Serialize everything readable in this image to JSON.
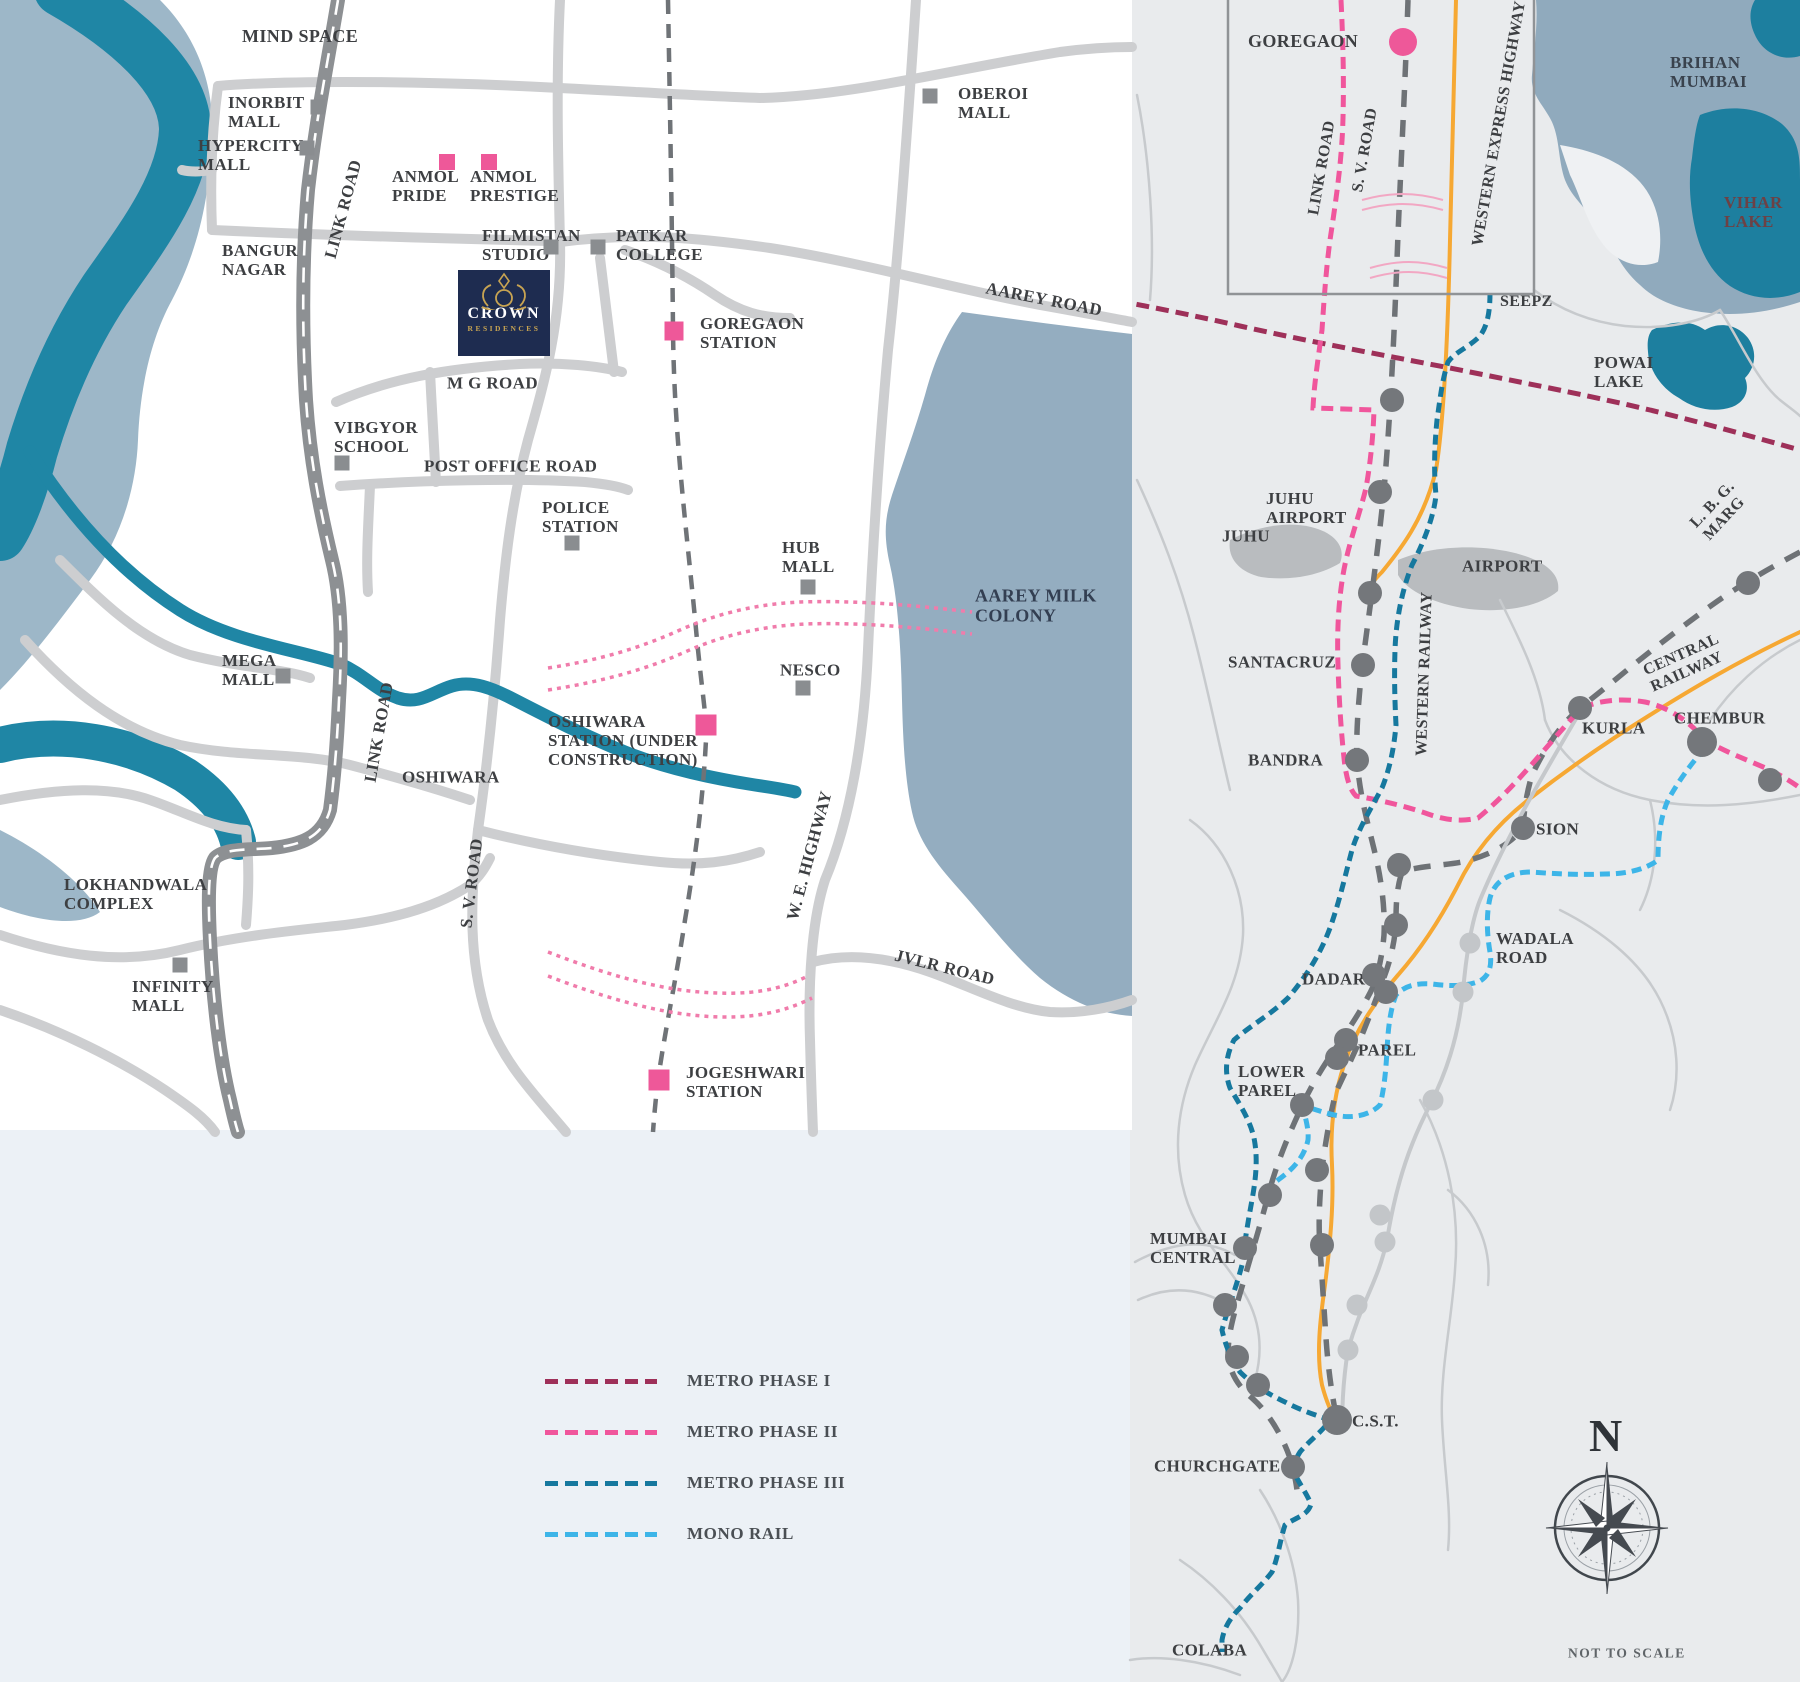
{
  "page": {
    "width": 1800,
    "height": 1682,
    "note": "NOT TO SCALE"
  },
  "colors": {
    "metro_phase_1": "#9e3059",
    "metro_phase_2": "#f0569c",
    "metro_phase_3": "#16789e",
    "mono_rail": "#3db5e8",
    "highway_orange": "#f6a833",
    "water_teal": "#1f86a5",
    "water_steel": "#9db7c8",
    "lake_dark": "#1d7f9f",
    "road_light": "#cdced0",
    "road_dark": "#8d9093",
    "station_pink": "#ee5899",
    "marker_gray": "#8a8d90",
    "label": "#3d3f42",
    "brand_navy": "#1e2c50",
    "brand_gold": "#c8a452"
  },
  "brand": {
    "name": "CROWN",
    "sub": "RESIDENCES"
  },
  "compass": {
    "north_label": "N",
    "note": "NOT TO SCALE"
  },
  "legend": {
    "items": [
      {
        "id": "metro-phase-1",
        "label": "METRO PHASE I",
        "color": "#9e3059",
        "y": 1371
      },
      {
        "id": "metro-phase-2",
        "label": "METRO PHASE II",
        "color": "#f0569c",
        "y": 1422
      },
      {
        "id": "metro-phase-3",
        "label": "METRO PHASE III",
        "color": "#16789e",
        "y": 1473
      },
      {
        "id": "mono-rail",
        "label": "MONO RAIL",
        "color": "#3db5e8",
        "y": 1524
      }
    ],
    "x": 545
  },
  "left_map": {
    "labels": [
      {
        "id": "mind-space",
        "text": "MIND SPACE",
        "x": 242,
        "y": 36,
        "size": 18
      },
      {
        "id": "inorbit-mall",
        "text": "INORBIT\nMALL",
        "x": 228,
        "y": 112
      },
      {
        "id": "hypercity-mall",
        "text": "HYPERCITY\nMALL",
        "x": 198,
        "y": 155
      },
      {
        "id": "bangur-nagar",
        "text": "BANGUR\nNAGAR",
        "x": 222,
        "y": 260
      },
      {
        "id": "link-road-upper",
        "text": "LINK ROAD",
        "x": 330,
        "y": 258,
        "rot": -75
      },
      {
        "id": "anmol-pride",
        "text": "ANMOL\nPRIDE",
        "x": 392,
        "y": 186
      },
      {
        "id": "anmol-prestige",
        "text": "ANMOL\nPRESTIGE",
        "x": 470,
        "y": 186
      },
      {
        "id": "filmistan-studio",
        "text": "FILMISTAN\nSTUDIO",
        "x": 482,
        "y": 245
      },
      {
        "id": "patkar-college",
        "text": "PATKAR\nCOLLEGE",
        "x": 616,
        "y": 245
      },
      {
        "id": "oberoi-mall",
        "text": "OBEROI\nMALL",
        "x": 958,
        "y": 103
      },
      {
        "id": "aarey-road",
        "text": "AAREY ROAD",
        "x": 986,
        "y": 288,
        "rot": 11
      },
      {
        "id": "goregaon-station",
        "text": "GOREGAON\nSTATION",
        "x": 700,
        "y": 333
      },
      {
        "id": "mg-road",
        "text": "M G ROAD",
        "x": 447,
        "y": 383
      },
      {
        "id": "vibgyor-school",
        "text": "VIBGYOR\nSCHOOL",
        "x": 334,
        "y": 437
      },
      {
        "id": "post-office-road",
        "text": "POST OFFICE ROAD",
        "x": 424,
        "y": 466
      },
      {
        "id": "police-station",
        "text": "POLICE\nSTATION",
        "x": 542,
        "y": 517
      },
      {
        "id": "hub-mall",
        "text": "HUB\nMALL",
        "x": 782,
        "y": 557
      },
      {
        "id": "nesco",
        "text": "NESCO",
        "x": 780,
        "y": 670
      },
      {
        "id": "aarey-milk-colony",
        "text": "AAREY MILK\nCOLONY",
        "x": 975,
        "y": 606,
        "color": "#333f52",
        "size": 18
      },
      {
        "id": "mega-mall",
        "text": "MEGA\nMALL",
        "x": 222,
        "y": 670
      },
      {
        "id": "oshiwara-station",
        "text": "OSHIWARA\nSTATION (UNDER\nCONSTRUCTION)",
        "x": 548,
        "y": 741
      },
      {
        "id": "oshiwara",
        "text": "OSHIWARA",
        "x": 402,
        "y": 777
      },
      {
        "id": "link-road-lower",
        "text": "LINK ROAD",
        "x": 370,
        "y": 782,
        "rot": -80
      },
      {
        "id": "sv-road-left",
        "text": "S. V. ROAD",
        "x": 466,
        "y": 928,
        "rot": -83
      },
      {
        "id": "we-highway",
        "text": "W. E. HIGHWAY",
        "x": 792,
        "y": 920,
        "rot": -75
      },
      {
        "id": "lokhandwala-complex",
        "text": "LOKHANDWALA\nCOMPLEX",
        "x": 64,
        "y": 894
      },
      {
        "id": "infinity-mall",
        "text": "INFINITY\nMALL",
        "x": 132,
        "y": 996
      },
      {
        "id": "jvlr-road",
        "text": "JVLR ROAD",
        "x": 895,
        "y": 955,
        "rot": 14
      },
      {
        "id": "jogeshwari-station",
        "text": "JOGESHWARI\nSTATION",
        "x": 686,
        "y": 1082
      }
    ],
    "pink_squares": [
      {
        "x": 447,
        "y": 162,
        "s": 16
      },
      {
        "x": 489,
        "y": 162,
        "s": 16
      },
      {
        "x": 674,
        "y": 331,
        "s": 19
      },
      {
        "x": 706,
        "y": 725,
        "s": 21
      },
      {
        "x": 659,
        "y": 1080,
        "s": 21
      }
    ],
    "gray_squares": [
      {
        "x": 318,
        "y": 107
      },
      {
        "x": 307,
        "y": 148
      },
      {
        "x": 551,
        "y": 247
      },
      {
        "x": 598,
        "y": 247
      },
      {
        "x": 930,
        "y": 96
      },
      {
        "x": 342,
        "y": 463
      },
      {
        "x": 572,
        "y": 543
      },
      {
        "x": 808,
        "y": 587
      },
      {
        "x": 803,
        "y": 688
      },
      {
        "x": 283,
        "y": 676
      },
      {
        "x": 180,
        "y": 965
      }
    ]
  },
  "right_map": {
    "labels": [
      {
        "id": "goregaon",
        "text": "GOREGAON",
        "x": 1248,
        "y": 41,
        "size": 18
      },
      {
        "id": "link-road",
        "text": "LINK ROAD",
        "x": 1314,
        "y": 215,
        "rot": -80,
        "size": 16
      },
      {
        "id": "sv-road",
        "text": "S. V. ROAD",
        "x": 1358,
        "y": 192,
        "rot": -80,
        "size": 16
      },
      {
        "id": "western-express-highway",
        "text": "WESTERN EXPRESS HIGHWAY",
        "x": 1478,
        "y": 246,
        "rot": -80,
        "size": 16
      },
      {
        "id": "brihan-mumbai",
        "text": "BRIHAN\nMUMBAI",
        "x": 1670,
        "y": 72,
        "color": "#39424d"
      },
      {
        "id": "vihar-lake",
        "text": "VIHAR\nLAKE",
        "x": 1724,
        "y": 212,
        "color": "#6d4145"
      },
      {
        "id": "seepz",
        "text": "SEEPZ",
        "x": 1500,
        "y": 302,
        "size": 16
      },
      {
        "id": "powai-lake",
        "text": "POWAI\nLAKE",
        "x": 1594,
        "y": 372
      },
      {
        "id": "lbg-marg",
        "text": "L. B. G. MARG",
        "x": 1700,
        "y": 532,
        "rot": -47,
        "size": 16
      },
      {
        "id": "central-railway",
        "text": "CENTRAL RAILWAY",
        "x": 1648,
        "y": 680,
        "rot": -24,
        "size": 16
      },
      {
        "id": "juhu-airport",
        "text": "JUHU\nAIRPORT",
        "x": 1266,
        "y": 508
      },
      {
        "id": "juhu",
        "text": "JUHU",
        "x": 1222,
        "y": 536
      },
      {
        "id": "airport",
        "text": "AIRPORT",
        "x": 1462,
        "y": 566
      },
      {
        "id": "santacruz",
        "text": "SANTACRUZ",
        "x": 1228,
        "y": 662
      },
      {
        "id": "western-railway",
        "text": "WESTERN RAILWAY",
        "x": 1422,
        "y": 756,
        "rot": -88,
        "size": 16
      },
      {
        "id": "bandra",
        "text": "BANDRA",
        "x": 1248,
        "y": 760
      },
      {
        "id": "kurla",
        "text": "KURLA",
        "x": 1582,
        "y": 728
      },
      {
        "id": "chembur",
        "text": "CHEMBUR",
        "x": 1674,
        "y": 718
      },
      {
        "id": "sion",
        "text": "SION",
        "x": 1536,
        "y": 829
      },
      {
        "id": "wadala-road",
        "text": "WADALA\nROAD",
        "x": 1496,
        "y": 948
      },
      {
        "id": "dadar",
        "text": "DADAR",
        "x": 1302,
        "y": 979
      },
      {
        "id": "parel",
        "text": "PAREL",
        "x": 1358,
        "y": 1050
      },
      {
        "id": "lower-parel",
        "text": "LOWER\nPAREL",
        "x": 1238,
        "y": 1081
      },
      {
        "id": "mumbai-central",
        "text": "MUMBAI\nCENTRAL",
        "x": 1150,
        "y": 1248
      },
      {
        "id": "cst",
        "text": "C.S.T.",
        "x": 1352,
        "y": 1421
      },
      {
        "id": "churchgate",
        "text": "CHURCHGATE",
        "x": 1154,
        "y": 1466
      },
      {
        "id": "colaba",
        "text": "COLABA",
        "x": 1172,
        "y": 1650
      }
    ],
    "stations_dark": [
      {
        "x": 1392,
        "y": 400
      },
      {
        "x": 1380,
        "y": 492
      },
      {
        "x": 1370,
        "y": 593
      },
      {
        "x": 1363,
        "y": 665
      },
      {
        "x": 1357,
        "y": 760
      },
      {
        "x": 1399,
        "y": 865
      },
      {
        "x": 1396,
        "y": 925
      },
      {
        "x": 1374,
        "y": 975
      },
      {
        "x": 1386,
        "y": 992
      },
      {
        "x": 1346,
        "y": 1040
      },
      {
        "x": 1337,
        "y": 1058
      },
      {
        "x": 1302,
        "y": 1105
      },
      {
        "x": 1270,
        "y": 1195
      },
      {
        "x": 1245,
        "y": 1248
      },
      {
        "x": 1225,
        "y": 1305
      },
      {
        "x": 1237,
        "y": 1357
      },
      {
        "x": 1258,
        "y": 1385
      },
      {
        "x": 1337,
        "y": 1420,
        "r": 15
      },
      {
        "x": 1293,
        "y": 1467
      },
      {
        "x": 1580,
        "y": 708
      },
      {
        "x": 1702,
        "y": 742,
        "r": 15
      },
      {
        "x": 1523,
        "y": 828
      },
      {
        "x": 1748,
        "y": 583
      },
      {
        "x": 1770,
        "y": 780
      },
      {
        "x": 1317,
        "y": 1170
      },
      {
        "x": 1322,
        "y": 1245
      }
    ],
    "stations_light": [
      {
        "x": 1470,
        "y": 943
      },
      {
        "x": 1463,
        "y": 992
      },
      {
        "x": 1433,
        "y": 1100
      },
      {
        "x": 1380,
        "y": 1215
      },
      {
        "x": 1385,
        "y": 1242
      },
      {
        "x": 1357,
        "y": 1305
      },
      {
        "x": 1348,
        "y": 1350
      }
    ],
    "origin_dot": {
      "x": 1403,
      "y": 42,
      "r": 14
    }
  }
}
